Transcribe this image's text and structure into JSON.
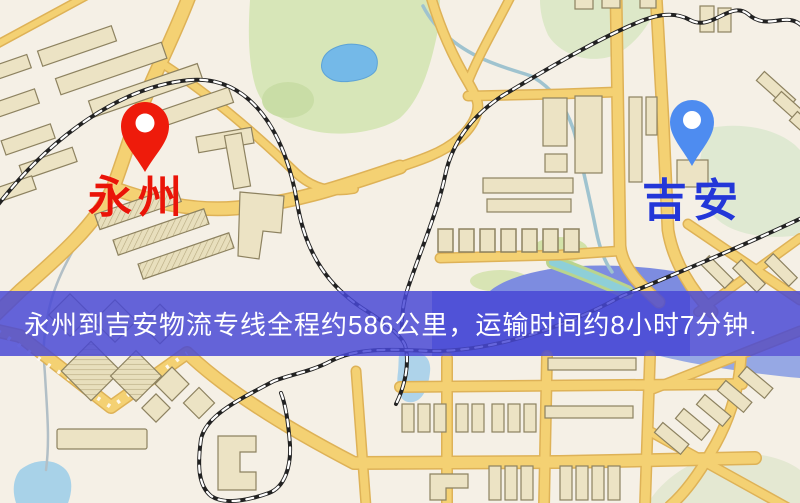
{
  "banner": {
    "text": "永州到吉安物流专线全程约586公里，运输时间约8小时7分钟.",
    "background_color": "#4848d5",
    "text_color": "#ffffff"
  },
  "origin": {
    "label": "永州",
    "label_color": "#ea1408",
    "pin_color": "#ee1b0b",
    "pin_icon": "red-map-pin"
  },
  "destination": {
    "label": "吉安",
    "label_color": "#2337d8",
    "pin_color": "#4e8cf0",
    "pin_icon": "blue-map-pin"
  },
  "map": {
    "palette": {
      "background": "#f5f0e6",
      "road": "#f4d173",
      "road_edge": "#deb257",
      "building": "#ece3c4",
      "building_outline": "#8d8260",
      "park": "#d8e6bb",
      "pond": "#74b9e8",
      "river": "#7d8ce0",
      "water_light": "#aed3ea",
      "railway": "#222222"
    }
  }
}
